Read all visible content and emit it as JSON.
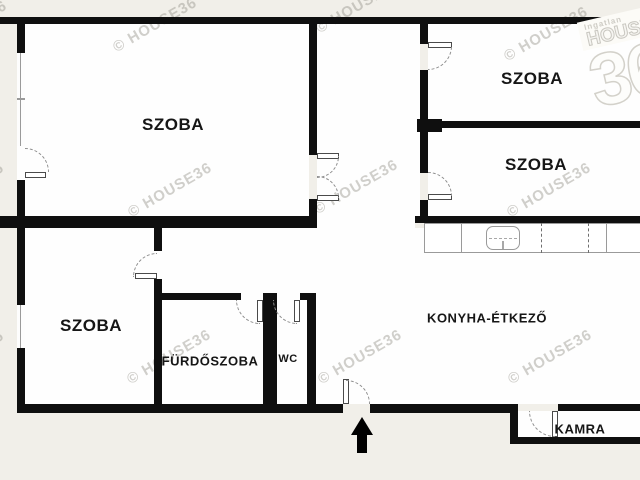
{
  "plan": {
    "rooms": [
      {
        "id": "szoba-main",
        "label": "SZOBA"
      },
      {
        "id": "szoba-top-right",
        "label": "SZOBA"
      },
      {
        "id": "szoba-mid-right",
        "label": "SZOBA"
      },
      {
        "id": "szoba-bottom-left",
        "label": "SZOBA"
      },
      {
        "id": "furdoszoba",
        "label": "FÜRDŐSZOBA"
      },
      {
        "id": "wc",
        "label": "WC"
      },
      {
        "id": "konyha-etkezo",
        "label": "KONYHA-ÉTKEZŐ"
      },
      {
        "id": "kamra",
        "label": "KAMRA"
      }
    ],
    "watermark": "© HOUSE36",
    "logo": {
      "line1": "Ingatlan",
      "line2": "HOUSE",
      "line3": "36"
    },
    "colors": {
      "background": "#f1efe9",
      "wall": "#0f0f0f",
      "room_fill": "#fefefe",
      "fixture_line": "#9a9a9a",
      "watermark": "#8f8c80"
    }
  }
}
